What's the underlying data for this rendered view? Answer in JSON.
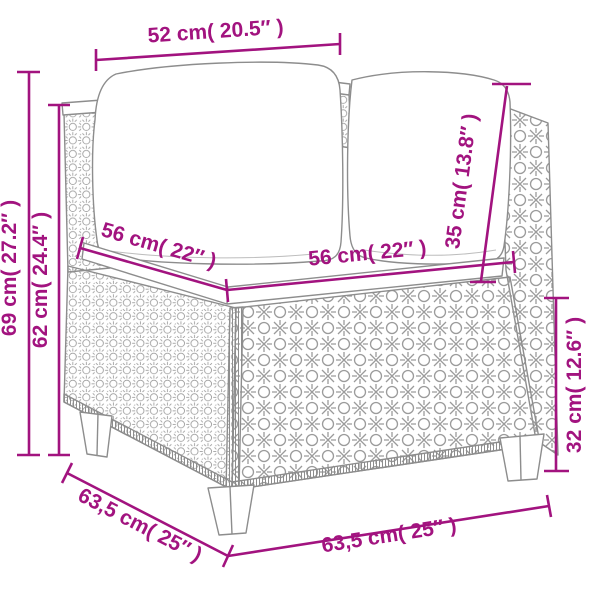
{
  "figure": {
    "type": "product-dimension-diagram",
    "subject": "poly rattan corner sofa section with back cushions and seat cushion",
    "colors": {
      "dimension_accent": "#A2137F",
      "line_art": "#8D8D8D",
      "background": "#FFFFFF"
    }
  },
  "dimensions": {
    "back_cushion_width": "52 cm( 20.5″ )",
    "overall_height": "69 cm( 27.2″ )",
    "seat_back_height": "62 cm( 24.4″ )",
    "seat_depth": "56 cm( 22″ )",
    "seat_width": "56 cm( 22″ )",
    "back_cushion_height": "35 cm( 13.8″ )",
    "base_height": "32 cm( 12.6″ )",
    "overall_depth": "63,5 cm( 25″ )",
    "overall_width": "63,5 cm( 25″ )"
  }
}
